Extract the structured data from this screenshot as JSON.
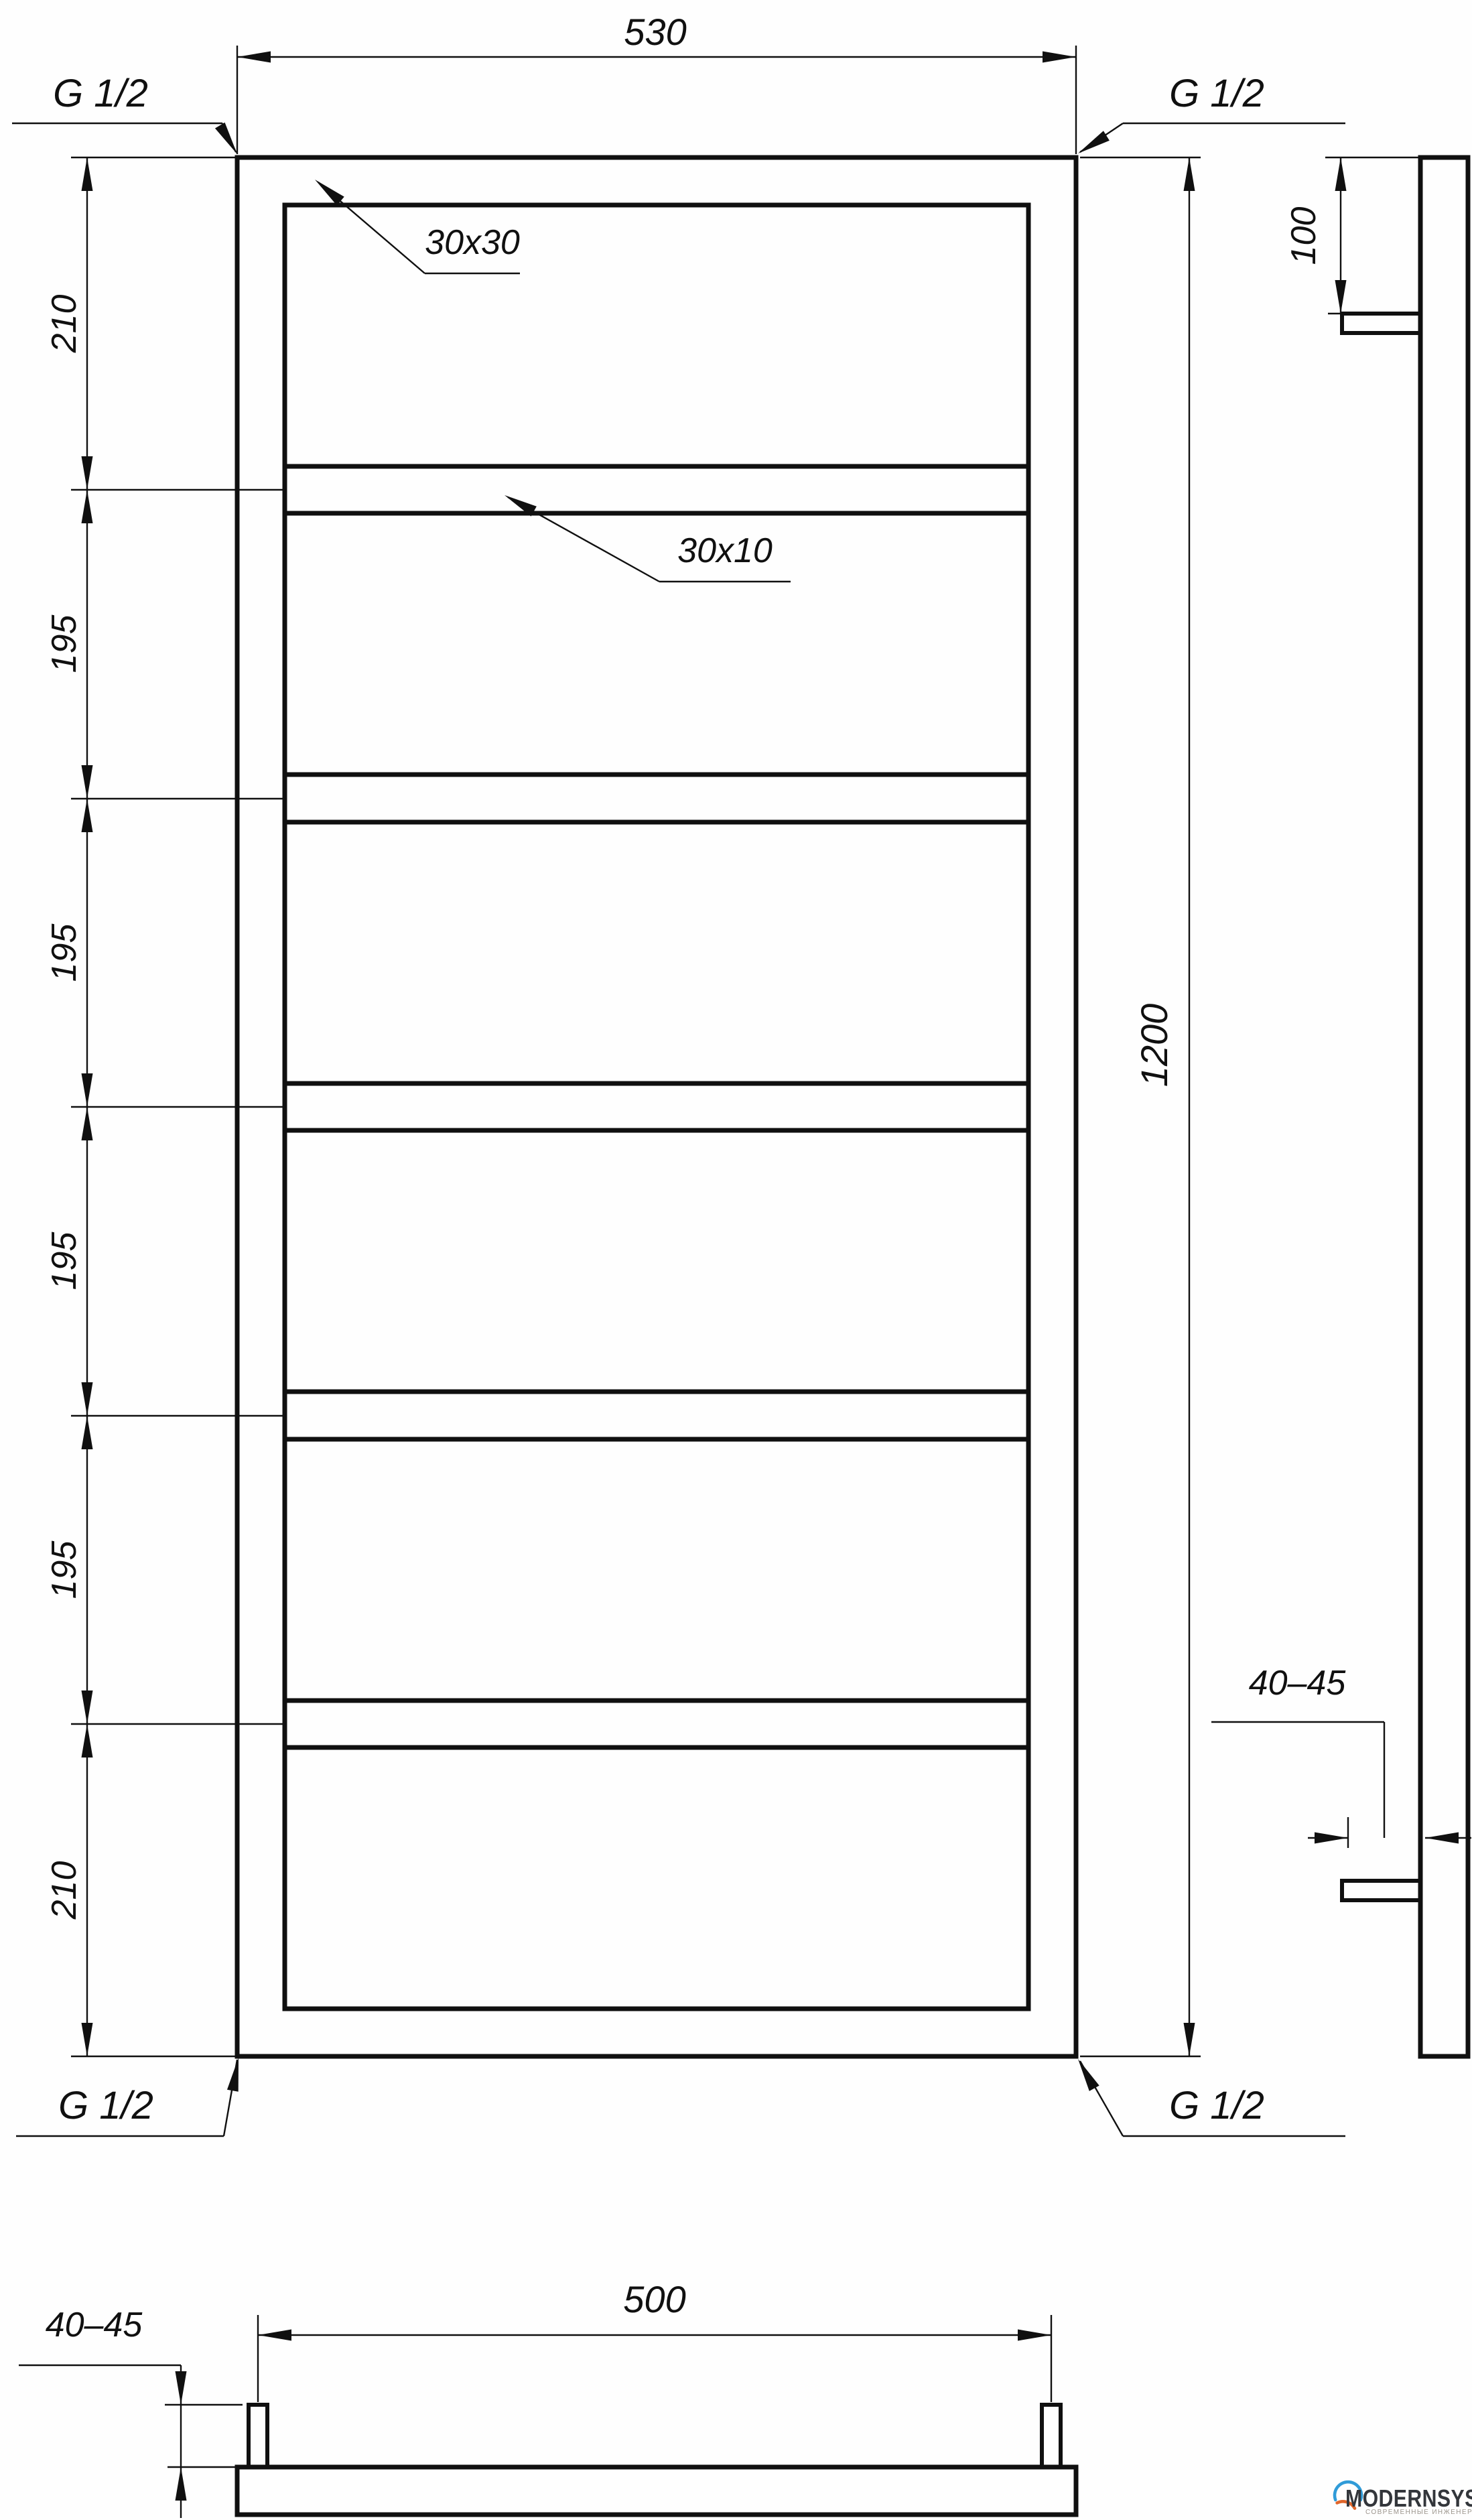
{
  "canvas": {
    "background": "#fefefe",
    "line_color": "#101010"
  },
  "front_view": {
    "top_width_label": "530",
    "right_height_label": "1200",
    "frame_profile_label": "30x30",
    "crossbar_profile_label": "30x10",
    "fitting_labels": {
      "top_left": "G 1/2",
      "top_right": "G 1/2",
      "bottom_left": "G 1/2",
      "bottom_right": "G 1/2"
    },
    "left_spacing_labels": [
      "210",
      "195",
      "195",
      "195",
      "195",
      "210"
    ]
  },
  "side_view": {
    "bracket_offset_label": "100",
    "wall_clearance_label": "40–45"
  },
  "bottom_view": {
    "bracket_spacing_label": "500",
    "wall_clearance_label": "40–45"
  },
  "logo": {
    "name": "MODERNSYS",
    "tagline": "СОВРЕМЕННЫЕ ИНЖЕНЕРНЫЕ СИСТЕМЫ",
    "blue": "#2f9bd8",
    "orange": "#e0662b"
  }
}
